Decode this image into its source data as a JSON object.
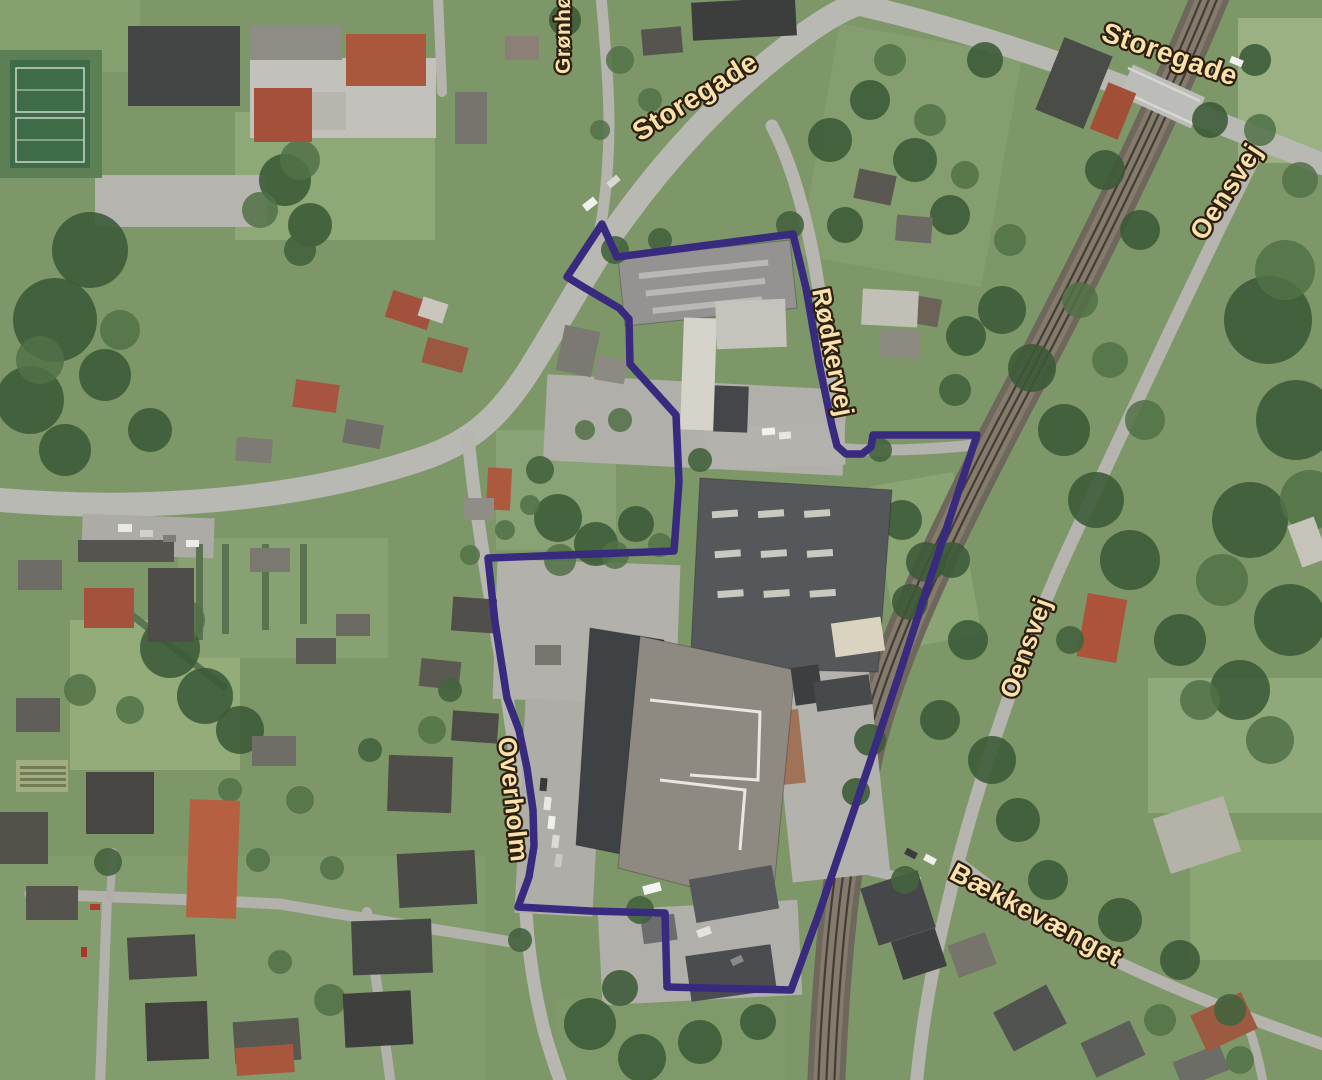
{
  "map": {
    "street_labels": [
      {
        "text": "Grønhøj",
        "x": 570,
        "y": 74,
        "rotation": -90,
        "size": 21
      },
      {
        "text": "Storegade",
        "x": 640,
        "y": 142,
        "rotation": -32,
        "size": 28
      },
      {
        "text": "Storegade",
        "x": 1100,
        "y": 40,
        "rotation": 19,
        "size": 28
      },
      {
        "text": "Oensvej",
        "x": 1204,
        "y": 242,
        "rotation": -57,
        "size": 27
      },
      {
        "text": "Rødkervej",
        "x": 812,
        "y": 290,
        "rotation": 79,
        "size": 26
      },
      {
        "text": "Oensvej",
        "x": 1016,
        "y": 700,
        "rotation": -70,
        "size": 26
      },
      {
        "text": "Overholm",
        "x": 498,
        "y": 738,
        "rotation": 84,
        "size": 26
      },
      {
        "text": "Bækkevænget",
        "x": 948,
        "y": 878,
        "rotation": 28,
        "size": 27
      }
    ],
    "label_style": {
      "fill": "#fbe2ac",
      "outline": "#2e2010"
    },
    "site_boundary": {
      "color": "#382a7e",
      "stroke_width": 7.5,
      "points": [
        [
          602,
          224
        ],
        [
          567,
          277
        ],
        [
          585,
          288
        ],
        [
          619,
          308
        ],
        [
          629,
          319
        ],
        [
          630,
          364
        ],
        [
          676,
          415
        ],
        [
          679,
          482
        ],
        [
          674,
          551
        ],
        [
          488,
          558
        ],
        [
          495,
          622
        ],
        [
          507,
          698
        ],
        [
          519,
          730
        ],
        [
          527,
          768
        ],
        [
          533,
          810
        ],
        [
          534,
          846
        ],
        [
          529,
          877
        ],
        [
          518,
          907
        ],
        [
          590,
          911
        ],
        [
          665,
          913
        ],
        [
          667,
          987
        ],
        [
          791,
          990
        ],
        [
          818,
          916
        ],
        [
          854,
          810
        ],
        [
          898,
          678
        ],
        [
          958,
          493
        ],
        [
          977,
          435
        ],
        [
          873,
          435
        ],
        [
          871,
          447
        ],
        [
          862,
          454
        ],
        [
          846,
          454
        ],
        [
          837,
          446
        ],
        [
          832,
          426
        ],
        [
          819,
          363
        ],
        [
          806,
          288
        ],
        [
          793,
          234
        ],
        [
          617,
          257
        ]
      ]
    }
  }
}
